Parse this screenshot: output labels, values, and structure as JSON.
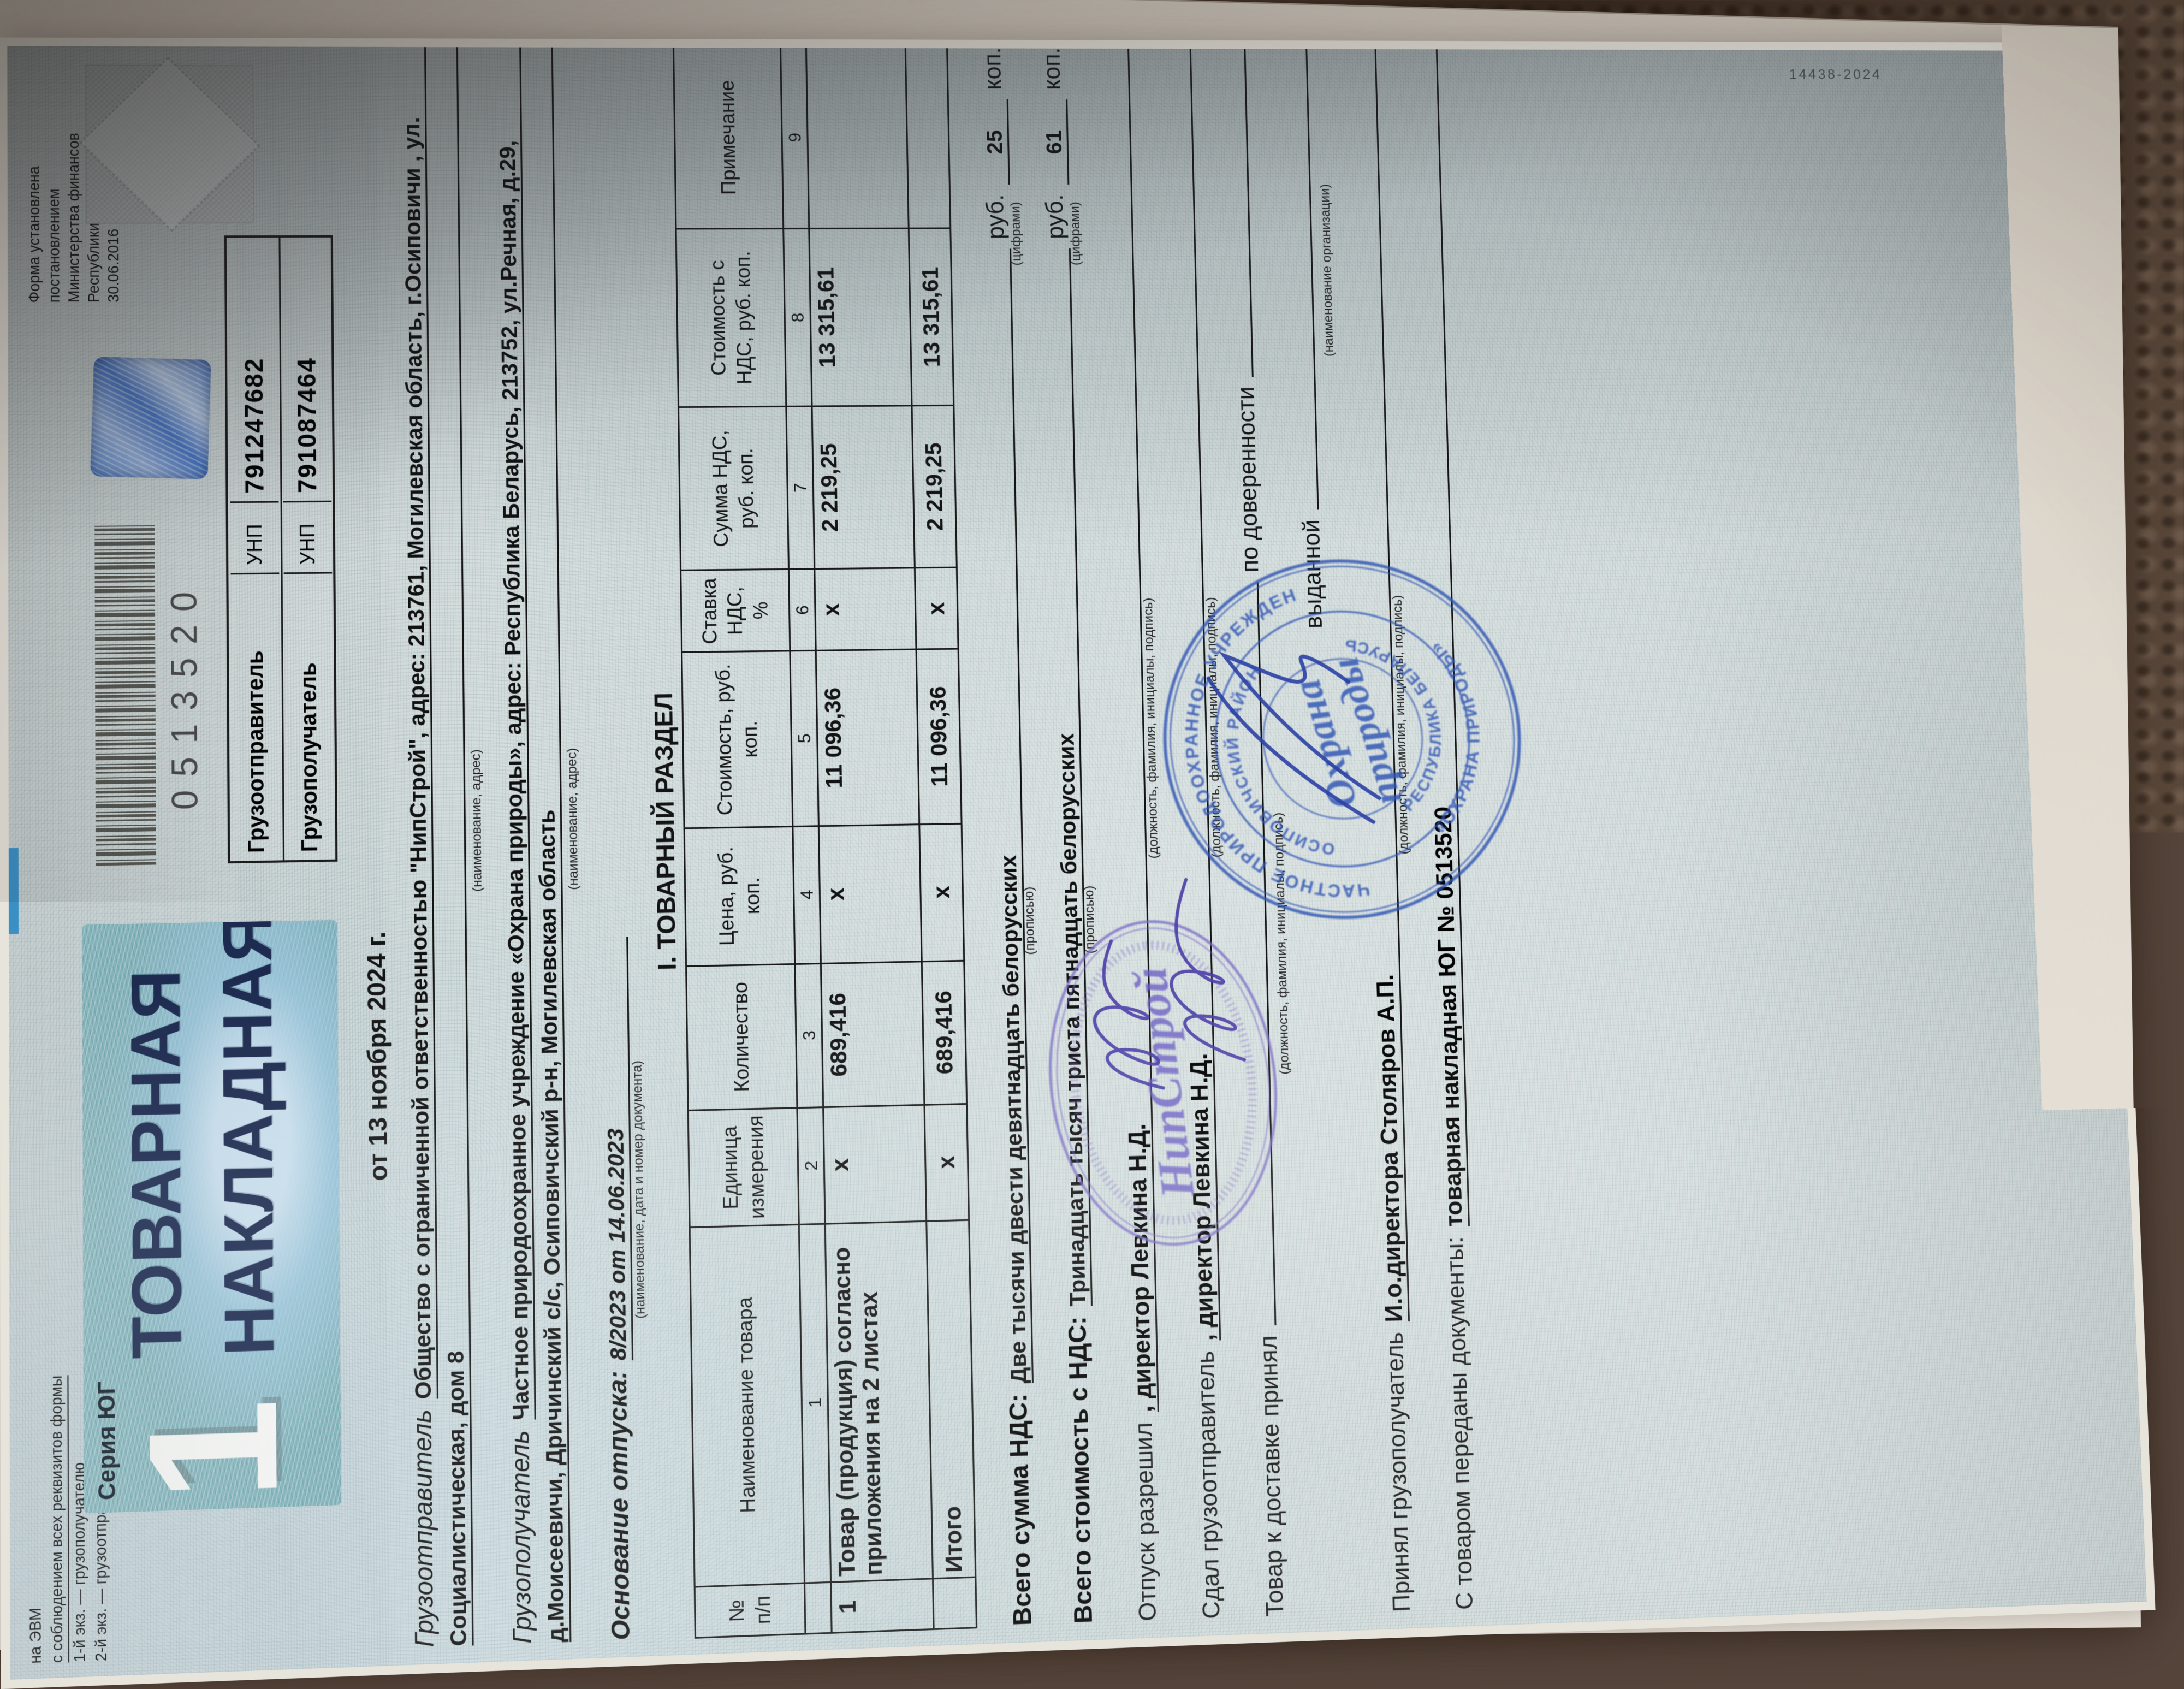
{
  "photo": {
    "scene": "товарная накладная лежит на коричневом ковре, повернута на 90°",
    "carpet_color": "#5a4839",
    "paper_color": "#d6dddd",
    "accent_blue": "#3d9bd5",
    "stamp_blue": "#2f55b5",
    "stamp_violet": "#6c5fc4"
  },
  "doc": {
    "corner_print": {
      "line0": "на ЭВМ",
      "line1": "с соблюдением всех реквизитов формы",
      "line2": "1-й экз. — грузополучателю",
      "line3": "2-й экз. — грузоотправителю"
    },
    "form_info": {
      "line1": "Форма установлена",
      "line2": "постановлением",
      "line3": "Министерства финансов",
      "line4": "Республики Беларусь",
      "line5": "30.06.2016 № 58"
    },
    "series_label": "Серия ЮГ",
    "copy_number": "1",
    "title_line1": "ТОВАРНАЯ",
    "title_line2": "НАКЛАДНАЯ",
    "barcode_number": "0513520",
    "unp_box": {
      "row1": {
        "label": "Грузоотправитель",
        "unp": "УНП",
        "number": "791247682"
      },
      "row2": {
        "label": "Грузополучатель",
        "unp": "УНП",
        "number": "791087464"
      }
    },
    "date_line": "от 13 ноября 2024 г.",
    "consignor": {
      "label": "Грузоотправитель",
      "line1": "Общество с ограниченной ответственностью \"НипСтрой\", адрес: 213761, Могилевская область, г.Осиповичи , ул.",
      "line2": "Социалистическая, дом 8",
      "caption": "(наименование, адрес)"
    },
    "consignee": {
      "label": "Грузополучатель",
      "line1": "Частное природоохранное учреждение «Охрана природы», адрес: Республика Беларусь, 213752, ул.Речная, д.29,",
      "line2": "д.Моисеевичи, Дричинский с/с, Осиповичский р-н, Могилевская область",
      "caption": "(наименование, адрес)"
    },
    "basis": {
      "label": "Основание отпуска:",
      "value": "8/2023 от 14.06.2023",
      "caption": "(наименование, дата и номер документа)"
    },
    "table": {
      "section_title": "І. ТОВАРНЫЙ РАЗДЕЛ",
      "headers": {
        "h0": "№ п/п",
        "h1": "Наименование товара",
        "h2": "Единица измерения",
        "h3": "Коли­чество",
        "h4": "Цена, руб. коп.",
        "h5": "Стоимость, руб. коп.",
        "h6": "Став­ка НДС, %",
        "h7": "Сумма НДС, руб. коп.",
        "h8": "Стоимость с НДС, руб. коп.",
        "h9": "Примечание"
      },
      "numbering": {
        "n1": "1",
        "n2": "2",
        "n3": "3",
        "n4": "4",
        "n5": "5",
        "n6": "6",
        "n7": "7",
        "n8": "8",
        "n9": "9"
      },
      "row": {
        "num": "1",
        "name": "Товар (продукция) согласно приложения на 2 листах",
        "unit": "х",
        "qty": "689,416",
        "price": "х",
        "cost": "11 096,36",
        "vat_rate": "х",
        "vat_sum": "2 219,25",
        "cost_with_vat": "13 315,61",
        "note": ""
      },
      "total": {
        "label": "Итого",
        "unit": "х",
        "qty": "689,416",
        "price": "х",
        "cost": "11 096,36",
        "vat_rate": "х",
        "vat_sum": "2 219,25",
        "cost_with_vat": "13 315,61"
      }
    },
    "totals": {
      "vat": {
        "label": "Всего сумма НДС:",
        "words": "Две тысячи двести девятнадцать белорусских",
        "caption_words": "(прописью)",
        "rub": "руб.",
        "kop_value": "25",
        "kop": "коп.",
        "caption_digits": "(цифрами)"
      },
      "cost": {
        "label": "Всего стоимость с НДС:",
        "words": "Тринадцать тысяч триста пятнадцать белорусских",
        "caption_words": "(прописью)",
        "rub": "руб.",
        "kop_value": "61",
        "kop": "коп.",
        "caption_digits": "(цифрами)"
      }
    },
    "sign_lines": {
      "s1": {
        "label": "Отпуск разрешил",
        "value": ", директор Левкина Н.Д.",
        "caption": "(должность, фамилия, инициалы, подпись)"
      },
      "s2": {
        "label": "Сдал грузоотправитель",
        "value": ", директор Левкина Н.Д.",
        "caption": "(должность, фамилия, инициалы, подпись)"
      },
      "s3": {
        "label": "Товар к доставке принял",
        "value": "",
        "caption": "(должность, фамилия, инициалы, подпись)",
        "extra": "по доверенности"
      },
      "s4": {
        "label": "выданной",
        "caption": "(наименование организации)"
      },
      "s5": {
        "label": "Принял грузополучатель",
        "value": "И.о.директора Столяров А.П.",
        "caption": "(должность, фамилия, инициалы, подпись)"
      }
    },
    "docs_line": {
      "label": "С товаром переданы документы:",
      "value": "товарная накладная ЮГ № 0513520"
    },
    "stamps": {
      "round": {
        "ring_outer_top": "ЧАСТНОЕ ПРИРОДООХРАННОЕ УЧРЕЖДЕНИЕ",
        "ring_outer_bottom": "«ОХРАНА ПРИРОДЫ»",
        "ring_inner_top": "ОСИПОВИЧСКИЙ РАЙОН",
        "ring_inner_bottom": "РЕСПУБЛИКА БЕЛАРУСЬ",
        "center_line1": "Охрана",
        "center_line2": "природы"
      },
      "oval": {
        "center": "НипСтрой"
      }
    },
    "edge_imprint": "14438-2024"
  }
}
